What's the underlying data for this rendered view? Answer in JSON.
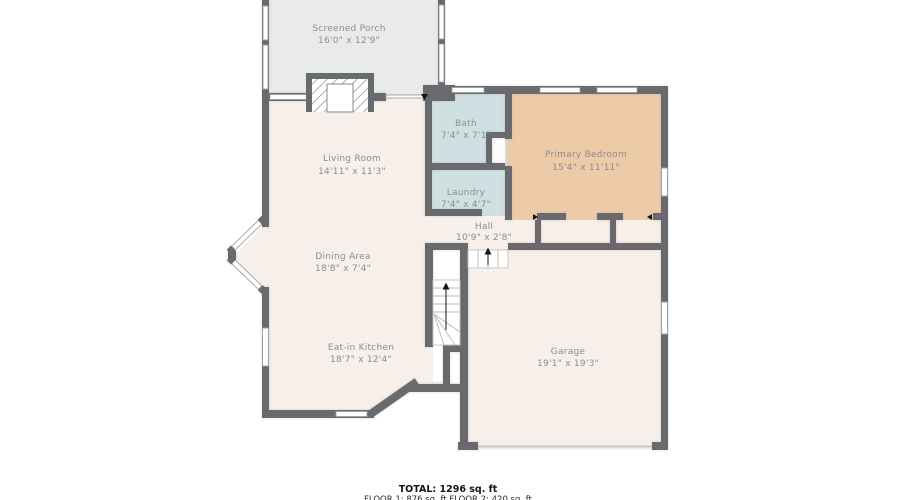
{
  "plan": {
    "rooms": {
      "screened_porch": {
        "label": "Screened Porch",
        "dims": "16'0\" x 12'9\""
      },
      "living_room": {
        "label": "Living Room",
        "dims": "14'11\" x 11'3\""
      },
      "bath": {
        "label": "Bath",
        "dims": "7'4\" x 7'1\""
      },
      "laundry": {
        "label": "Laundry",
        "dims": "7'4\" x 4'7\""
      },
      "primary_bedroom": {
        "label": "Primary Bedroom",
        "dims": "15'4\" x 11'11\""
      },
      "hall": {
        "label": "Hall",
        "dims": "10'9\" x 2'8\""
      },
      "dining_area": {
        "label": "Dining Area",
        "dims": "18'8\" x 7'4\""
      },
      "eat_in_kitchen": {
        "label": "Eat-in Kitchen",
        "dims": "18'7\" x 12'4\""
      },
      "garage": {
        "label": "Garage",
        "dims": "19'1\" x 19'3\""
      }
    },
    "footer": {
      "total": "TOTAL: 1296 sq. ft",
      "floors": "FLOOR 1: 876 sq. ft  FLOOR 2: 420 sq. ft"
    },
    "colors": {
      "wall": "#686b6e",
      "floor_main": "#f7efe9",
      "floor_porch": "#e9eaea",
      "floor_wet": "#cfe0e2",
      "floor_bedroom": "#edcaa8"
    }
  }
}
